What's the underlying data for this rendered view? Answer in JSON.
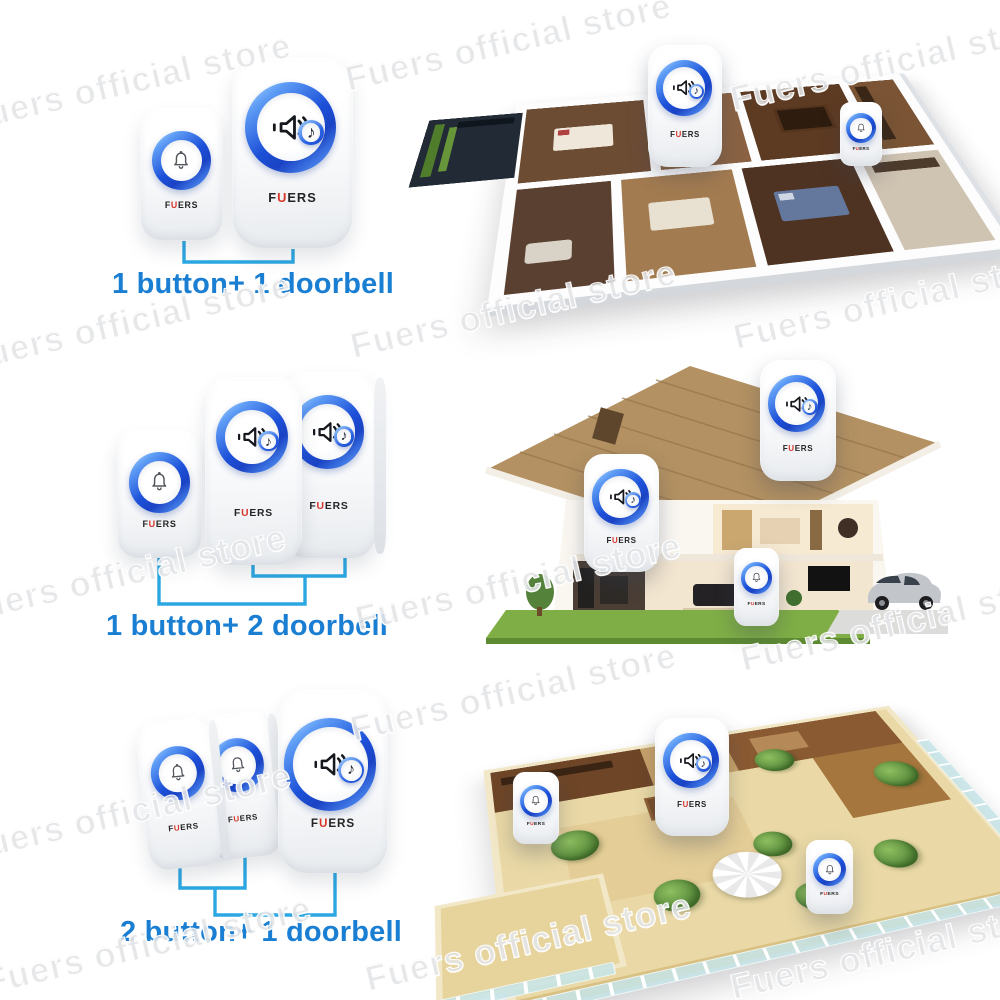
{
  "watermark": {
    "text": "Fuers official store"
  },
  "brand": {
    "name": "FUERS",
    "logo_f": "F",
    "logo_u": "U",
    "logo_rest": "ERS"
  },
  "groups": [
    {
      "label": "1 button+ 1 doorbell",
      "buttons": 1,
      "doorbells": 1,
      "scene": "apartment floor plan"
    },
    {
      "label": "1 button+ 2 doorbell",
      "buttons": 1,
      "doorbells": 2,
      "scene": "two-storey house cutaway"
    },
    {
      "label": "2 button+ 1 doorbell",
      "buttons": 2,
      "doorbells": 1,
      "scene": "terrace apartment"
    }
  ],
  "icons": {
    "speaker": "speaker-icon",
    "bell": "bell-icon",
    "note": "music-note-icon",
    "note_glyph": "♪"
  },
  "colors": {
    "label_blue": "#1a7fd2",
    "bracket_blue": "#2ba7e2",
    "ring_blue": "#1c50d8",
    "logo_red": "#d8352a"
  }
}
